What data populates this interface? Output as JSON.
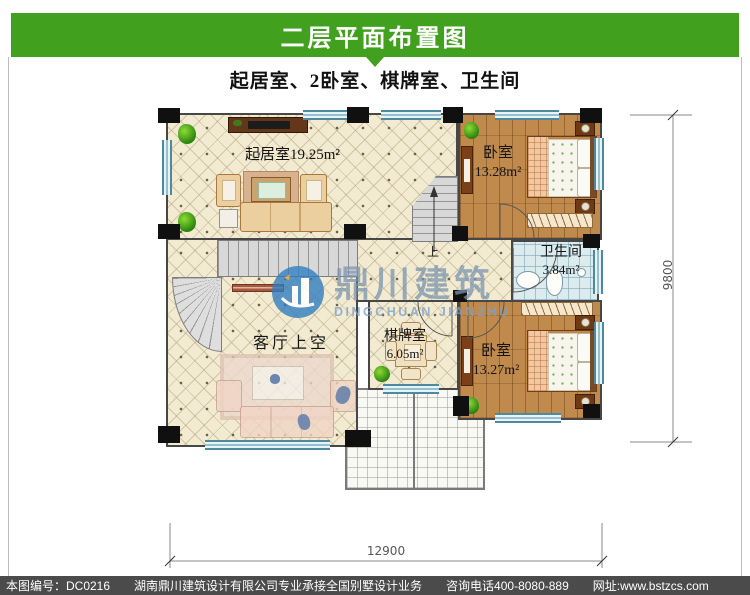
{
  "title_bar": {
    "text": "二层平面布置图"
  },
  "subtitle": {
    "text": "起居室、2卧室、棋牌室、卫生间"
  },
  "plan": {
    "rooms": {
      "living": {
        "name": "起居室",
        "area": "19.25m²"
      },
      "bedroom_top": {
        "name": "卧室",
        "area": "13.28m²"
      },
      "bathroom": {
        "name": "卫生间",
        "area": "3.84m²"
      },
      "chess": {
        "name": "棋牌室",
        "area": "6.05m²"
      },
      "bedroom_bottom": {
        "name": "卧室",
        "area": "13.27m²"
      },
      "void": {
        "name": "客厅上空"
      }
    },
    "stair_label": "上",
    "dim_width": "12900",
    "dim_height": "9800"
  },
  "watermark": {
    "cn": "鼎川建筑",
    "en": "DINGCHUAN JIANZHU"
  },
  "footer": {
    "sheet_no": "本图编号：DC0216",
    "company": "湖南鼎川建筑设计有限公司专业承接全国别墅设计业务",
    "phone": "咨询电话400-8080-889",
    "website": "网址:www.bstzcs.com"
  },
  "colors": {
    "banner_green": "#41a01d",
    "footer_gray": "#4b4b4b",
    "watermark_blue": "#2f7cc0",
    "window_blue": "#4d8aa0",
    "tile_beige": "#f2ebd1",
    "wood_brown": "#c08a4c"
  }
}
